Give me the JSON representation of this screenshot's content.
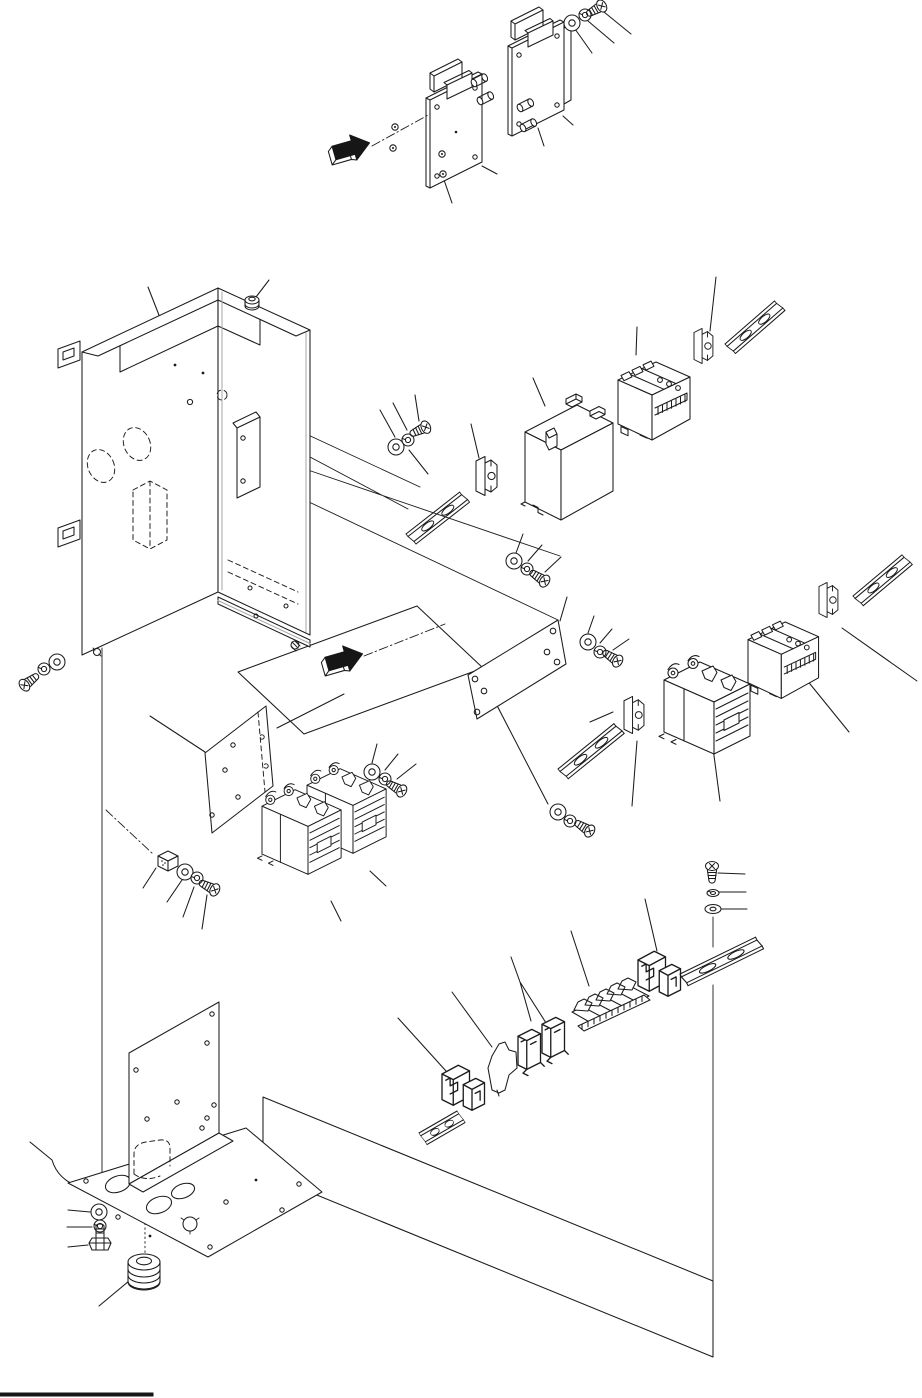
{
  "figure": {
    "kind": "exploded-parts-diagram",
    "subject": "Electrical control box assembly",
    "text_labels_visible": false
  },
  "palette": {
    "background": "#ffffff",
    "line": "#1b1b1b",
    "arrow_fill": "#161616",
    "edge_gray": "#a8a8a8",
    "footer_rule": "#111111"
  },
  "components": [
    {
      "id": "top-arrow",
      "label": "Assembly direction arrow (top)"
    },
    {
      "id": "pcb-plate-left",
      "label": "Circuit board plate (left)"
    },
    {
      "id": "pcb-plate-right",
      "label": "Circuit board plate (right)"
    },
    {
      "id": "pcb-spacers",
      "label": "Cylindrical spacers"
    },
    {
      "id": "pcb-studs",
      "label": "Mounting studs"
    },
    {
      "id": "fastener-set-a",
      "label": "Flat washer, spring washer and screw (board)"
    },
    {
      "id": "enclosure",
      "label": "Sheet-metal box enclosure"
    },
    {
      "id": "mount-tabs",
      "label": "Wall-mount tabs"
    },
    {
      "id": "top-bushing",
      "label": "Cable bushing (top rim)"
    },
    {
      "id": "inner-bracket",
      "label": "Inner mounting bracket"
    },
    {
      "id": "fastener-set-d",
      "label": "Screw, spring washer and flat washer (flange)"
    },
    {
      "id": "middle-arrow",
      "label": "Assembly direction arrow (panel)"
    },
    {
      "id": "panel-outline",
      "label": "Mounting panel outline"
    },
    {
      "id": "fastener-set-b",
      "label": "Flat washer, spring washer and screw (upper rail)"
    },
    {
      "id": "din-rail-1",
      "label": "DIN rail (upper left)"
    },
    {
      "id": "clamp-1",
      "label": "Rail end clamp (upper left)"
    },
    {
      "id": "transformer",
      "label": "Transformer block"
    },
    {
      "id": "breaker-1",
      "label": "Circuit breaker (upper)"
    },
    {
      "id": "clamp-2",
      "label": "Rail end clamp (upper right)"
    },
    {
      "id": "din-rail-2",
      "label": "DIN rail (upper right)"
    },
    {
      "id": "fastener-set-c",
      "label": "Flat washer, spring washer and screw (center)"
    },
    {
      "id": "plate-center",
      "label": "Mounting plate (center)"
    },
    {
      "id": "fastener-set-e",
      "label": "Flat washer, spring washer and screw (plate)"
    },
    {
      "id": "din-rail-4",
      "label": "DIN rail (middle)"
    },
    {
      "id": "clamp-4",
      "label": "Rail end clamp (middle)"
    },
    {
      "id": "contactor-single",
      "label": "Magnetic contactor (right)"
    },
    {
      "id": "breaker-2",
      "label": "Circuit breaker (right)"
    },
    {
      "id": "clamp-3",
      "label": "Rail end clamp (right)"
    },
    {
      "id": "din-rail-3",
      "label": "DIN rail (right)"
    },
    {
      "id": "fastener-set-f",
      "label": "Flat washer, spring washer and screw (below plate)"
    },
    {
      "id": "plate-left",
      "label": "Mounting plate (left)"
    },
    {
      "id": "filter-cube",
      "label": "Terminal cube"
    },
    {
      "id": "fastener-set-h",
      "label": "Flat washer, spring washer and screw (cube)"
    },
    {
      "id": "contactor-pair",
      "label": "Magnetic contactors (pair)"
    },
    {
      "id": "fastener-set-g",
      "label": "Flat washer, spring washer and screw (contactor)"
    },
    {
      "id": "fastener-set-i",
      "label": "Screw, spring washer and flat washer (terminal rail)"
    },
    {
      "id": "anchor-right",
      "label": "Terminal end anchors (right)"
    },
    {
      "id": "terminal-strip",
      "label": "Terminal block strip"
    },
    {
      "id": "terminal-singles",
      "label": "Terminal blocks (pair)"
    },
    {
      "id": "separator",
      "label": "Terminal separator plate"
    },
    {
      "id": "anchor-left",
      "label": "Terminal end anchors (left)"
    },
    {
      "id": "din-rail-6",
      "label": "DIN rail (terminal, right)"
    },
    {
      "id": "din-rail-5",
      "label": "DIN rail (terminal, left)"
    },
    {
      "id": "rear-panel-outline",
      "label": "Rear panel outline"
    },
    {
      "id": "l-bracket",
      "label": "L-shaped mounting bracket"
    },
    {
      "id": "base-plate",
      "label": "Base plate with cable holes"
    },
    {
      "id": "fastener-set-j",
      "label": "Hex bolt, spring washer and flat washer (base)"
    },
    {
      "id": "grommet",
      "label": "Rubber grommet"
    },
    {
      "id": "footer-rule",
      "label": "Footer rule"
    }
  ]
}
